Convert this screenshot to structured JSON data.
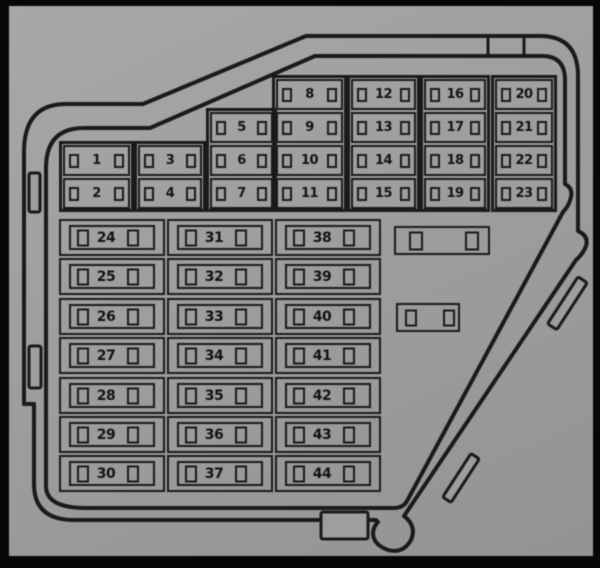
{
  "colors": {
    "paper": "#9d9d9d",
    "line": "#1c1c1c",
    "frame": "#070707"
  },
  "top_grid": {
    "columns": [
      {
        "fuses": [
          "1",
          "2"
        ],
        "start_row": 2
      },
      {
        "fuses": [
          "3",
          "4"
        ],
        "start_row": 2
      },
      {
        "fuses": [
          "5",
          "6",
          "7"
        ],
        "start_row": 1
      },
      {
        "fuses": [
          "8",
          "9",
          "10",
          "11"
        ],
        "start_row": 0
      },
      {
        "fuses": [
          "12",
          "13",
          "14",
          "15"
        ],
        "start_row": 0
      },
      {
        "fuses": [
          "16",
          "17",
          "18",
          "19"
        ],
        "start_row": 0
      },
      {
        "fuses": [
          "20",
          "21",
          "22",
          "23"
        ],
        "start_row": 0
      }
    ]
  },
  "bottom_grid": {
    "columns": [
      {
        "fuses": [
          "24",
          "25",
          "26",
          "27",
          "28",
          "29",
          "30"
        ]
      },
      {
        "fuses": [
          "31",
          "32",
          "33",
          "34",
          "35",
          "36",
          "37"
        ]
      },
      {
        "fuses": [
          "38",
          "39",
          "40",
          "41",
          "42",
          "43",
          "44"
        ]
      }
    ]
  },
  "unlabeled_slots": [
    {
      "position": "upper"
    },
    {
      "position": "lower"
    }
  ]
}
